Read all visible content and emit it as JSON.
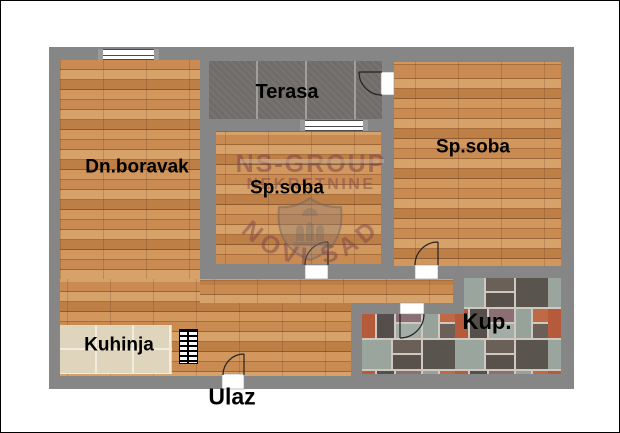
{
  "rooms": {
    "terrace": {
      "label": "Terasa"
    },
    "living": {
      "label": "Dn.boravak"
    },
    "bedroom1": {
      "label": "Sp.soba"
    },
    "bedroom2": {
      "label": "Sp.soba"
    },
    "kitchen": {
      "label": "Kuhinja"
    },
    "bathroom": {
      "label": "Kup."
    },
    "entrance": {
      "label": "Ulaz"
    }
  },
  "watermark": {
    "brand": "NS-GROUP",
    "line2": "NEKRETNINE",
    "city": "NOVI SAD"
  },
  "colors": {
    "wall": "#868686",
    "wood": "#c08048",
    "terrace_tile": "#6f6c69",
    "kitchen_tile": "#ded5bc",
    "bathroom_grout": "#cfc8c1",
    "watermark": "#7c454c",
    "label_text": "#000000",
    "symbol_line": "#222222",
    "background": "#ffffff"
  }
}
